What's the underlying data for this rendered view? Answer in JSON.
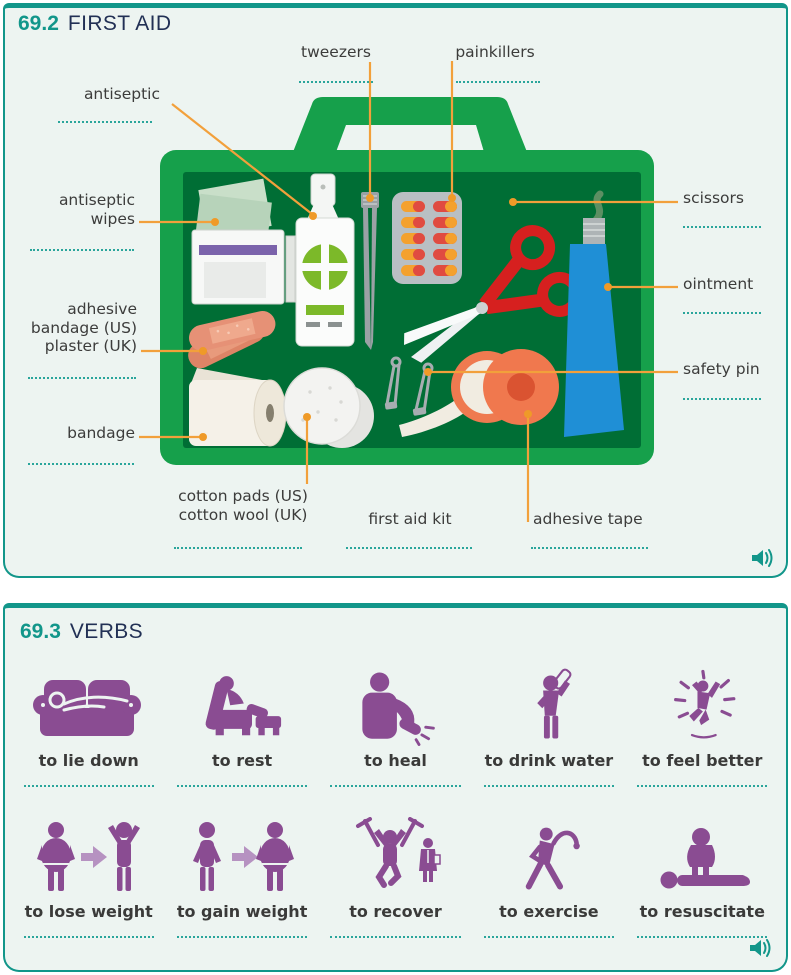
{
  "colors": {
    "teal_accent": "#12968a",
    "panel_background": "#edf4f1",
    "heading_navy": "#223055",
    "label_gray": "#3c3c3b",
    "leader_orange": "#f2a03b",
    "verb_purple": "#8a4c92",
    "kit_green": "#16a04b",
    "kit_dark_green": "#006e35",
    "scissors_red": "#d6201f",
    "ointment_blue": "#1f8fd6",
    "tape_coral": "#f0784e",
    "plaster_salmon": "#e69176",
    "pill_red": "#e04b41",
    "pill_orange": "#f4a12e"
  },
  "panel_first_aid": {
    "number": "69.2",
    "title": "FIRST AID",
    "audio_icon": "speaker-icon",
    "labels": {
      "tweezers": "tweezers",
      "painkillers": "painkillers",
      "antiseptic": "antiseptic",
      "antiseptic_wipes": "antiseptic\nwipes",
      "adhesive_bandage": "adhesive\nbandage (US)\nplaster (UK)",
      "bandage": "bandage",
      "cotton_pads": "cotton pads (US)\ncotton wool (UK)",
      "first_aid_kit": "first aid kit",
      "adhesive_tape": "adhesive tape",
      "scissors": "scissors",
      "ointment": "ointment",
      "safety_pin": "safety pin"
    }
  },
  "panel_verbs": {
    "number": "69.3",
    "title": "VERBS",
    "audio_icon": "speaker-icon",
    "verbs": [
      {
        "label": "to lie down",
        "icon": "lie-down-icon"
      },
      {
        "label": "to rest",
        "icon": "rest-icon"
      },
      {
        "label": "to heal",
        "icon": "heal-icon"
      },
      {
        "label": "to drink water",
        "icon": "drink-water-icon"
      },
      {
        "label": "to feel better",
        "icon": "feel-better-icon"
      },
      {
        "label": "to lose weight",
        "icon": "lose-weight-icon"
      },
      {
        "label": "to gain weight",
        "icon": "gain-weight-icon"
      },
      {
        "label": "to recover",
        "icon": "recover-icon"
      },
      {
        "label": "to exercise",
        "icon": "exercise-icon"
      },
      {
        "label": "to resuscitate",
        "icon": "resuscitate-icon"
      }
    ]
  }
}
